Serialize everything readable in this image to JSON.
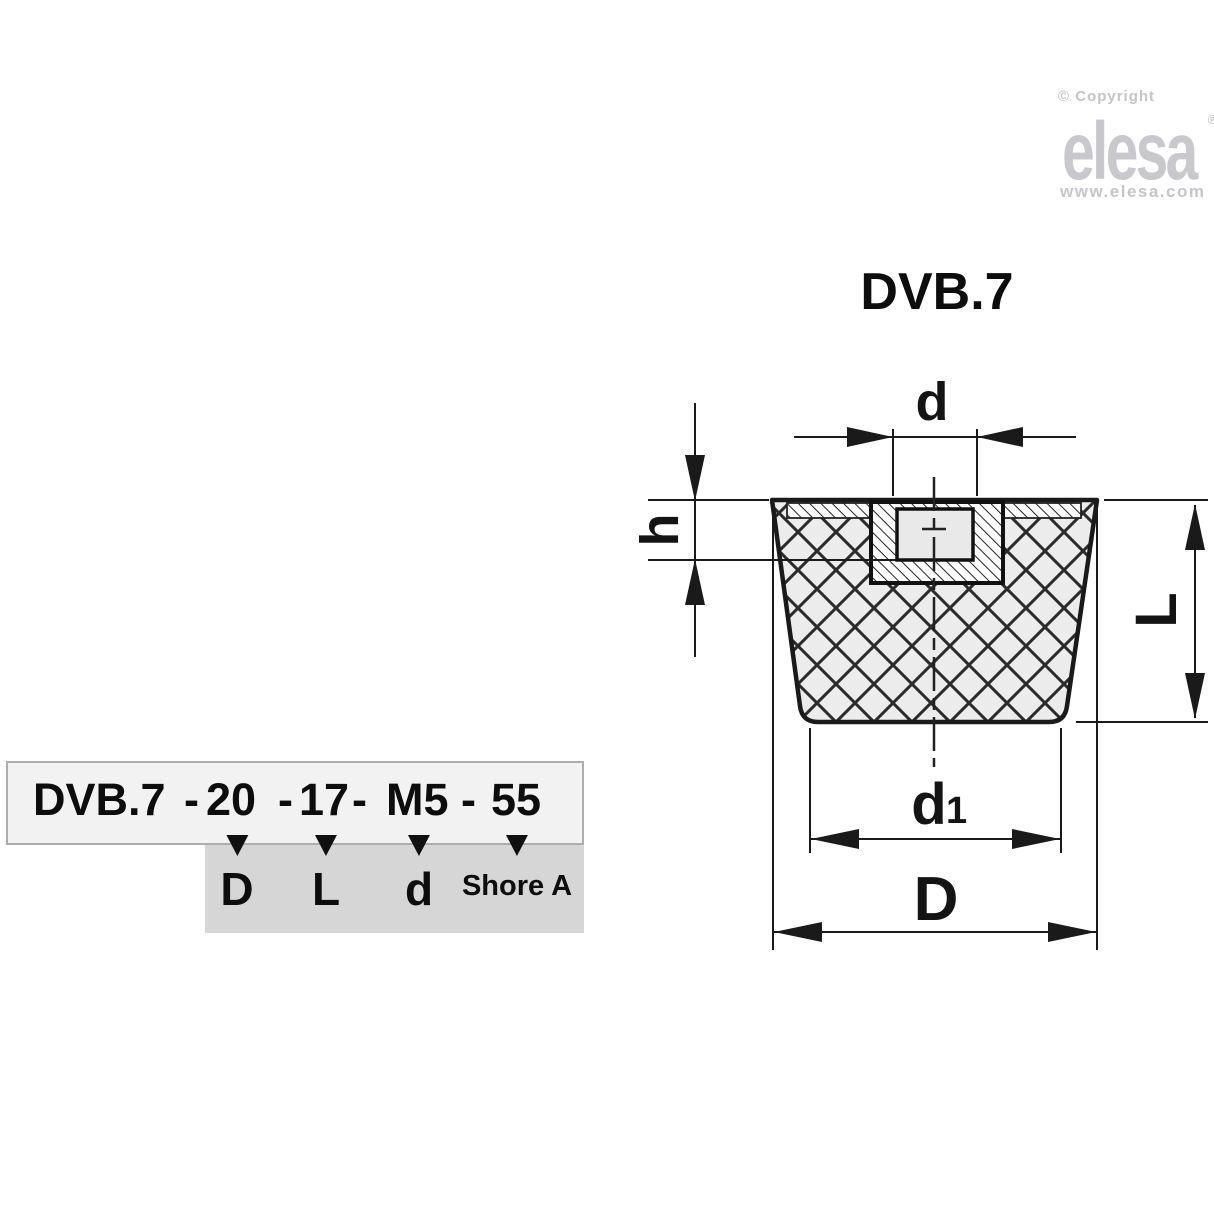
{
  "branding": {
    "copyright": "© Copyright",
    "logo": "elesa",
    "registered": "®",
    "website": "www.elesa.com",
    "gray": "#c7c7cb"
  },
  "drawing": {
    "title": "DVB.7",
    "labels": {
      "d": "d",
      "h": "h",
      "L": "L",
      "d1_main": "d",
      "d1_sub": "1",
      "D": "D"
    },
    "colors": {
      "line": "#1a1a1a",
      "rubber_fill": "#ececec",
      "hole_fill": "#e9e9e9"
    }
  },
  "ordering_code": {
    "prefix": "DVB.7",
    "separator": "-",
    "parts": [
      {
        "value": "20",
        "label": "D"
      },
      {
        "value": "17",
        "label": "L"
      },
      {
        "value": "M5",
        "label": "d"
      },
      {
        "value": "55",
        "label": "Shore A"
      }
    ],
    "box_fill": "#f2f2f2",
    "label_box_fill": "#d6d6d6"
  }
}
